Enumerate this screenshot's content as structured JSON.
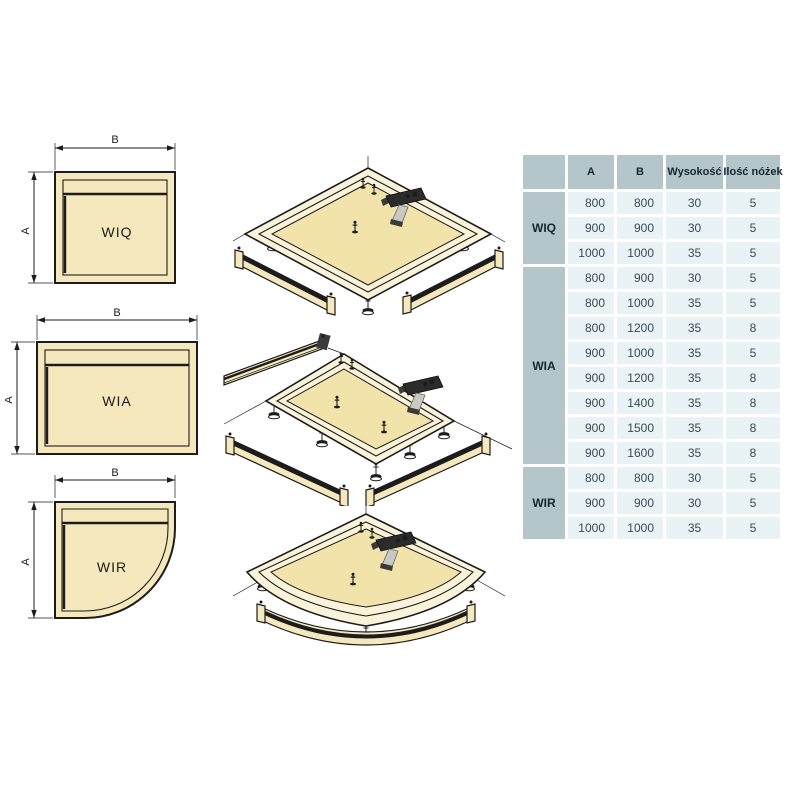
{
  "labels": {
    "dim_width": "B",
    "dim_height": "A"
  },
  "models": {
    "wiq": "WIQ",
    "wia": "WIA",
    "wir": "WIR"
  },
  "colors": {
    "line": "#1c1c1c",
    "tray_fill": "#f5e8bd",
    "rim_fill": "#faf3da",
    "floor_fill": "#f2e3aa",
    "table_header_bg": "#b4c6ca",
    "table_cell_bg": "#e9f2f4",
    "table_head_text": "#17262e",
    "table_text": "#3a4a53"
  },
  "table": {
    "headers": [
      "A",
      "B",
      "Wysokość",
      "Ilość nóżek"
    ],
    "groups": [
      {
        "label": "WIQ",
        "rows": [
          [
            "800",
            "800",
            "30",
            "5"
          ],
          [
            "900",
            "900",
            "30",
            "5"
          ],
          [
            "1000",
            "1000",
            "35",
            "5"
          ]
        ]
      },
      {
        "label": "WIA",
        "rows": [
          [
            "800",
            "900",
            "30",
            "5"
          ],
          [
            "800",
            "1000",
            "35",
            "5"
          ],
          [
            "800",
            "1200",
            "35",
            "8"
          ],
          [
            "900",
            "1000",
            "35",
            "5"
          ],
          [
            "900",
            "1200",
            "35",
            "8"
          ],
          [
            "900",
            "1400",
            "35",
            "8"
          ],
          [
            "900",
            "1500",
            "35",
            "8"
          ],
          [
            "900",
            "1600",
            "35",
            "8"
          ]
        ]
      },
      {
        "label": "WIR",
        "rows": [
          [
            "800",
            "800",
            "30",
            "5"
          ],
          [
            "900",
            "900",
            "30",
            "5"
          ],
          [
            "1000",
            "1000",
            "35",
            "5"
          ]
        ]
      }
    ]
  }
}
